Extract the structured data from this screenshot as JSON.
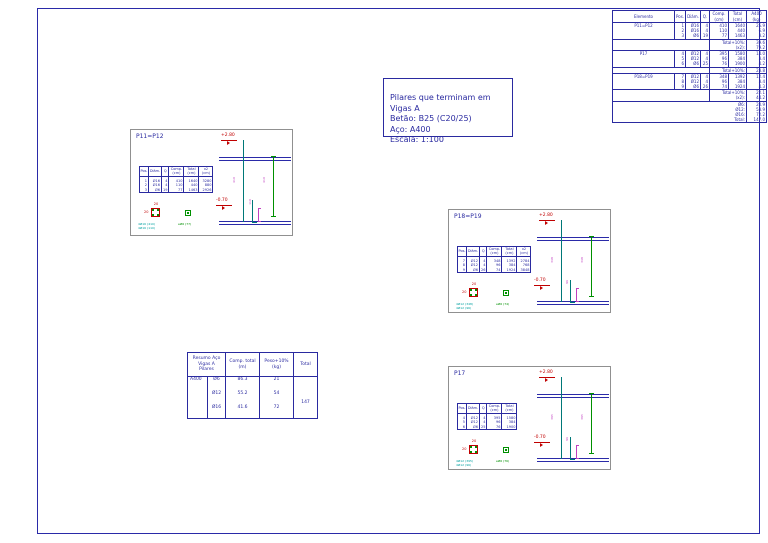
{
  "notes_box": {
    "text": "Pilares que terminam em\nVigas A\nBetão: B25 (C20/25)\nAço: A400\nEscala: 1:100"
  },
  "summary_table": {
    "headers": [
      "Elemento",
      "Pos.",
      "Diâm.",
      "Q.",
      "Comp. (cm)",
      "Total (cm)",
      "A400 (kg)"
    ],
    "elements": [
      {
        "name": "P11=P12",
        "rows": [
          [
            "1",
            "Ø16",
            "4",
            "410",
            "1640",
            "25.9"
          ],
          [
            "2",
            "Ø16",
            "4",
            "110",
            "440",
            "6.9"
          ],
          [
            "3",
            "Ø6",
            "19",
            "77",
            "1463",
            "3.2"
          ]
        ],
        "subtotals": [
          {
            "label": "Total+10%:",
            "value": "39.6"
          },
          {
            "label": "(x2):",
            "value": "79.2"
          }
        ]
      },
      {
        "name": "P17",
        "rows": [
          [
            "4",
            "Ø12",
            "4",
            "395",
            "1580",
            "14.0"
          ],
          [
            "5",
            "Ø12",
            "4",
            "96",
            "384",
            "3.4"
          ],
          [
            "6",
            "Ø6",
            "25",
            "76",
            "1900",
            "4.2"
          ]
        ],
        "subtotals": [
          {
            "label": "Total+10%:",
            "value": "23.8"
          }
        ]
      },
      {
        "name": "P18=P19",
        "rows": [
          [
            "7",
            "Ø12",
            "4",
            "348",
            "1392",
            "12.4"
          ],
          [
            "8",
            "Ø12",
            "4",
            "96",
            "384",
            "3.4"
          ],
          [
            "9",
            "Ø6",
            "26",
            "74",
            "1924",
            "4.3"
          ]
        ],
        "subtotals": [
          {
            "label": "Total+10%:",
            "value": "22.1"
          },
          {
            "label": "(x2):",
            "value": "44.2"
          }
        ]
      }
    ],
    "grand_totals": [
      {
        "label": "Ø6:",
        "value": "20.9"
      },
      {
        "label": "Ø12:",
        "value": "53.9"
      },
      {
        "label": "Ø16:",
        "value": "72.2"
      },
      {
        "label": "Total:",
        "value": "147.0"
      }
    ]
  },
  "details": [
    {
      "title": "P11=P12",
      "level_top": "+2.80",
      "level_bottom": "-0.70",
      "bar_table": {
        "headers": [
          "Pos.",
          "Diâm.",
          "Q",
          "Comp. (cm)",
          "Total (cm)",
          "x2 (cm)"
        ],
        "rows": [
          [
            "1",
            "Ø16",
            "4",
            "410",
            "1640",
            "3280"
          ],
          [
            "2",
            "Ø16",
            "4",
            "110",
            "440",
            "880"
          ],
          [
            "3",
            "Ø6",
            "19",
            "77",
            "1463",
            "2926"
          ]
        ]
      },
      "section": {
        "dim_top": "20",
        "dim_side": "20",
        "caption1": "4Ø16 (410)",
        "caption2": "4Ø16 (110)",
        "stirrup_caption": "eØ6 (77)"
      },
      "bar_label_left": "410",
      "bar_label_right": "410",
      "lap_label": "110"
    },
    {
      "title": "P18=P19",
      "level_top": "+2.80",
      "level_bottom": "-0.70",
      "bar_table": {
        "headers": [
          "Pos.",
          "Diâm.",
          "Q",
          "Comp. (cm)",
          "Total (cm)",
          "x2 (cm)"
        ],
        "rows": [
          [
            "7",
            "Ø12",
            "4",
            "348",
            "1392",
            "2784"
          ],
          [
            "8",
            "Ø12",
            "4",
            "96",
            "384",
            "768"
          ],
          [
            "9",
            "Ø6",
            "26",
            "74",
            "1924",
            "3848"
          ]
        ]
      },
      "section": {
        "dim_top": "20",
        "dim_side": "20",
        "caption1": "4Ø12 (348)",
        "caption2": "4Ø12 (96)",
        "stirrup_caption": "eØ6 (74)"
      },
      "bar_label_left": "348",
      "bar_label_right": "348",
      "lap_label": "96"
    },
    {
      "title": "P17",
      "level_top": "+2.80",
      "level_bottom": "-0.70",
      "bar_table": {
        "headers": [
          "Pos.",
          "Diâm.",
          "Q",
          "Comp. (cm)",
          "Total (cm)"
        ],
        "rows": [
          [
            "4",
            "Ø12",
            "4",
            "395",
            "1580"
          ],
          [
            "5",
            "Ø12",
            "4",
            "96",
            "384"
          ],
          [
            "6",
            "Ø6",
            "25",
            "76",
            "1900"
          ]
        ]
      },
      "section": {
        "dim_top": "20",
        "dim_side": "20",
        "caption1": "4Ø12 (395)",
        "caption2": "4Ø12 (96)",
        "stirrup_caption": "eØ6 (76)"
      },
      "bar_label_left": "395",
      "bar_label_right": "395",
      "lap_label": "96"
    }
  ],
  "resumo_table": {
    "title": "Resumo Aço\nVigas A\nPilares",
    "comp_header": "Comp. total\n(m)",
    "peso_header": "Peso+10%\n(kg)",
    "total_header": "Total",
    "total_value": "147",
    "rows": [
      {
        "grade": "A400",
        "diam": "Ø6",
        "comp": "86.3",
        "peso": "21"
      },
      {
        "grade": "",
        "diam": "Ø12",
        "comp": "55.2",
        "peso": "54"
      },
      {
        "grade": "",
        "diam": "Ø16",
        "comp": "41.6",
        "peso": "72"
      }
    ]
  }
}
